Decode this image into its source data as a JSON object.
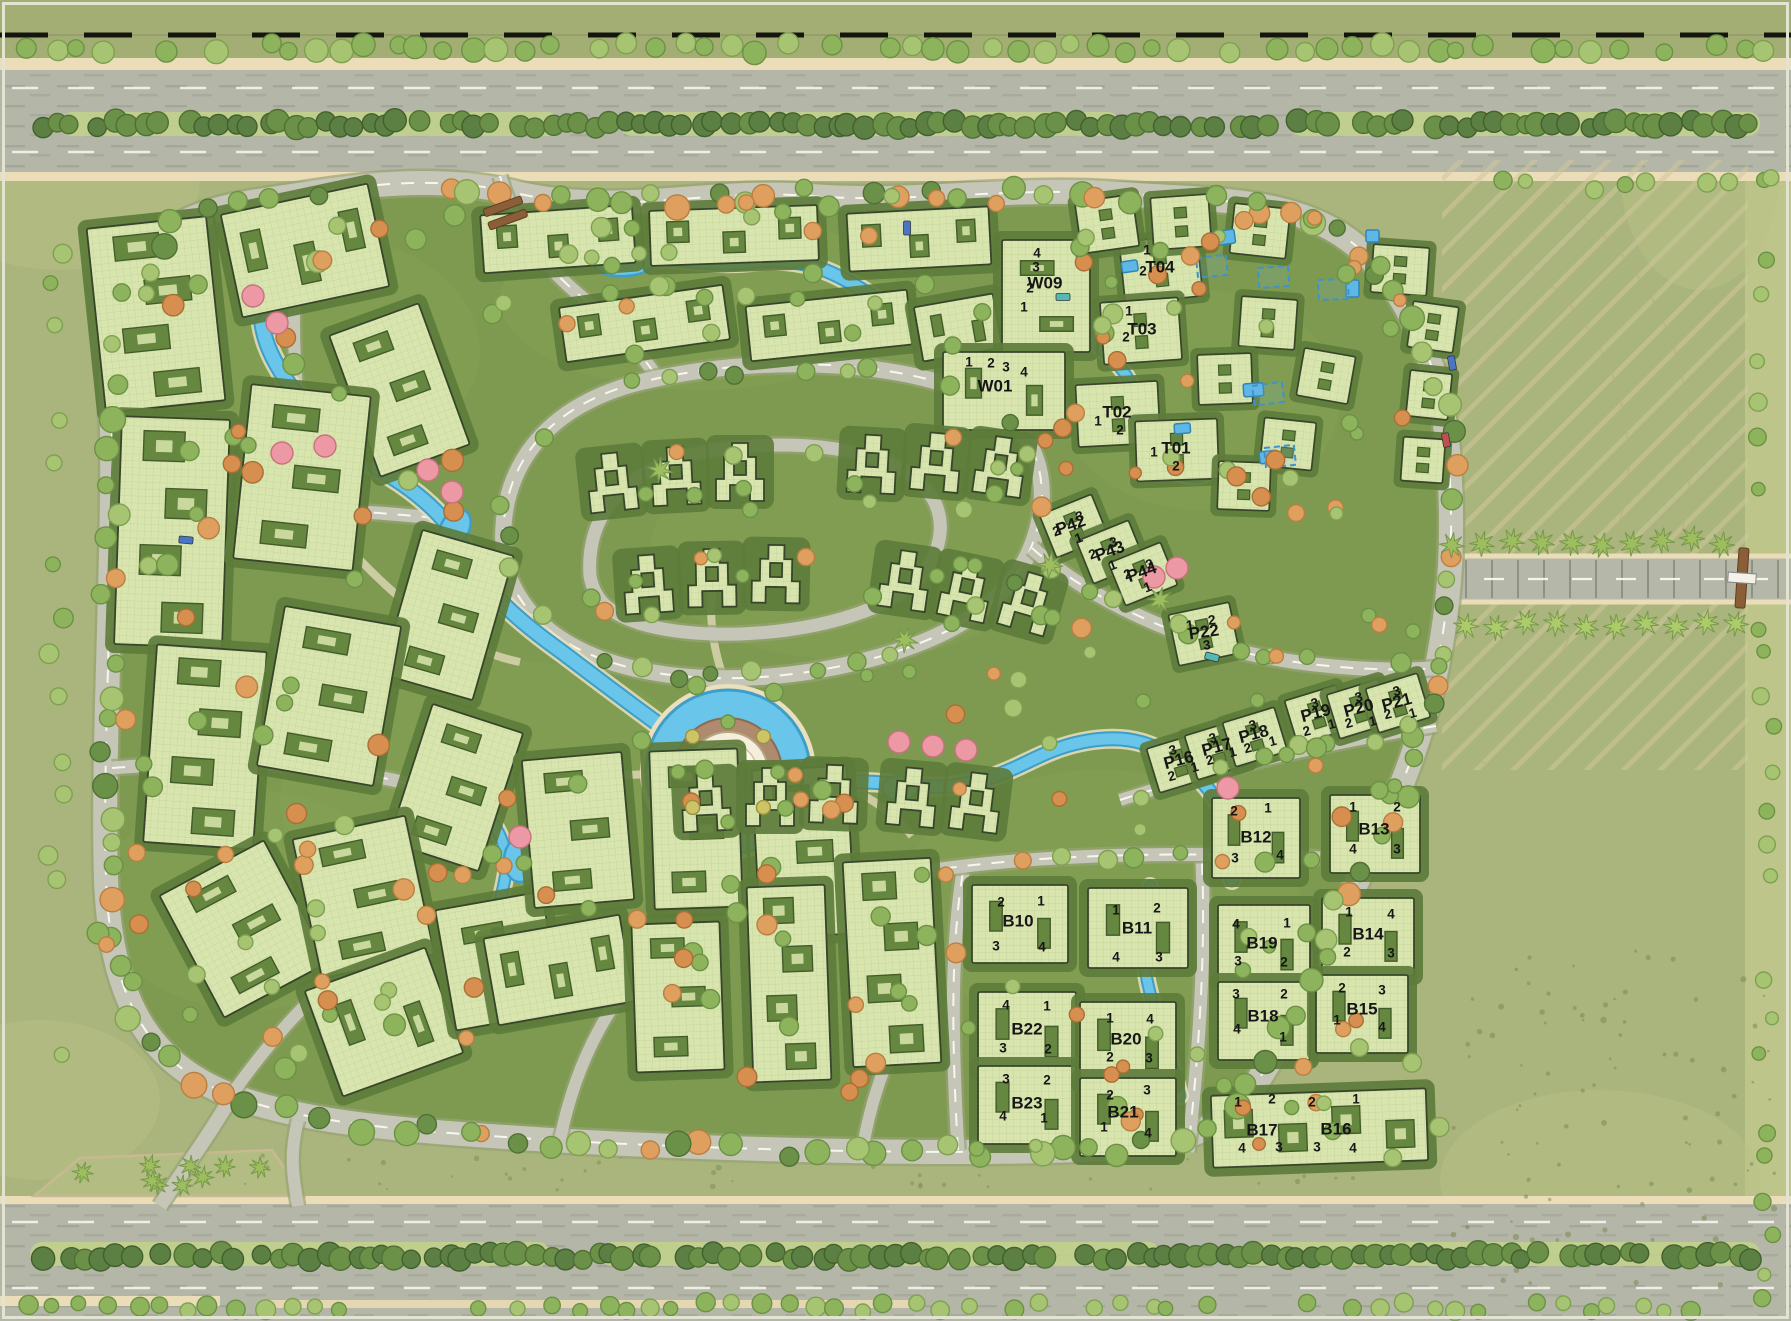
{
  "canvas": {
    "width": 1791,
    "height": 1321
  },
  "palette": {
    "land": "#aab47d",
    "land_light": "#c0c78c",
    "grass": "#7e9a50",
    "garden": "#5d7c3b",
    "building": "#d8e5ae",
    "outline": "#37462a",
    "courtyard": "#66873f",
    "courtyard_inner": "#d4e2a9",
    "road": "#c5c6b7",
    "highway": "#b4b6a8",
    "sidewalk": "#eaddb8",
    "road_line": "#fcfcf5",
    "water": "#69c6ea",
    "water_edge": "#3d9ec9",
    "water_bank": "#e9e0bd",
    "label": "#161616",
    "hatch": "#cfc79b",
    "plaza": "#b08a6e",
    "dome": "#f4eedb",
    "pool": "#5fb7e8",
    "gate": "#8a5f38",
    "tree_green": "#8db45c",
    "tree_light": "#a6c472",
    "tree_dark": "#5c7f43",
    "tree_orange": "#dfa05f",
    "tree_pink": "#ec99a5",
    "palm": "#9dbd5e"
  },
  "buildings": [
    {
      "id": "W09",
      "x": 1045,
      "y": 284,
      "rot": 0,
      "units": [
        [
          "4",
          1037,
          254
        ],
        [
          "3",
          1036,
          268
        ],
        [
          "2",
          1030,
          289
        ],
        [
          "1",
          1024,
          308
        ]
      ]
    },
    {
      "id": "W01",
      "x": 995,
      "y": 387,
      "rot": 0,
      "units": [
        [
          "1",
          969,
          363
        ],
        [
          "2",
          991,
          364
        ],
        [
          "3",
          1006,
          368
        ],
        [
          "4",
          1024,
          373
        ]
      ]
    },
    {
      "id": "T04",
      "x": 1160,
      "y": 268,
      "rot": 0,
      "units": [
        [
          "1",
          1147,
          251
        ],
        [
          "2",
          1143,
          272
        ]
      ]
    },
    {
      "id": "T03",
      "x": 1142,
      "y": 330,
      "rot": 0,
      "units": [
        [
          "1",
          1129,
          312
        ],
        [
          "2",
          1126,
          338
        ]
      ]
    },
    {
      "id": "T02",
      "x": 1117,
      "y": 413,
      "rot": 0,
      "units": [
        [
          "1",
          1098,
          422
        ],
        [
          "2",
          1120,
          431
        ]
      ]
    },
    {
      "id": "T01",
      "x": 1176,
      "y": 449,
      "rot": 0,
      "units": [
        [
          "1",
          1154,
          453
        ],
        [
          "2",
          1176,
          467
        ]
      ]
    },
    {
      "id": "P42",
      "x": 1071,
      "y": 526,
      "rot": -20,
      "units": [
        [
          "3",
          1080,
          517
        ],
        [
          "2",
          1057,
          532
        ],
        [
          "1",
          1079,
          539
        ]
      ]
    },
    {
      "id": "P43",
      "x": 1110,
      "y": 552,
      "rot": -20,
      "units": [
        [
          "3",
          1114,
          543
        ],
        [
          "2",
          1093,
          555
        ],
        [
          "1",
          1113,
          566
        ]
      ]
    },
    {
      "id": "P44",
      "x": 1142,
      "y": 573,
      "rot": -20,
      "units": [
        [
          "3",
          1150,
          565
        ],
        [
          "2",
          1128,
          575
        ],
        [
          "1",
          1148,
          588
        ]
      ]
    },
    {
      "id": "P22",
      "x": 1204,
      "y": 633,
      "rot": -8,
      "units": [
        [
          "1",
          1190,
          626
        ],
        [
          "2",
          1212,
          621
        ],
        [
          "3",
          1207,
          646
        ]
      ]
    },
    {
      "id": "P16",
      "x": 1179,
      "y": 761,
      "rot": -15,
      "units": [
        [
          "3",
          1173,
          751
        ],
        [
          "2",
          1172,
          777
        ],
        [
          "1",
          1195,
          768
        ]
      ]
    },
    {
      "id": "P17",
      "x": 1217,
      "y": 748,
      "rot": -15,
      "units": [
        [
          "3",
          1213,
          739
        ],
        [
          "2",
          1210,
          761
        ],
        [
          "1",
          1233,
          753
        ]
      ]
    },
    {
      "id": "P18",
      "x": 1254,
      "y": 735,
      "rot": -15,
      "units": [
        [
          "3",
          1253,
          726
        ],
        [
          "2",
          1248,
          749
        ],
        [
          "1",
          1273,
          742
        ]
      ]
    },
    {
      "id": "P19",
      "x": 1316,
      "y": 714,
      "rot": -15,
      "units": [
        [
          "3",
          1315,
          704
        ],
        [
          "2",
          1307,
          732
        ],
        [
          "1",
          1332,
          725
        ]
      ]
    },
    {
      "id": "P20",
      "x": 1359,
      "y": 709,
      "rot": -15,
      "units": [
        [
          "3",
          1359,
          698
        ],
        [
          "2",
          1349,
          724
        ],
        [
          "1",
          1373,
          722
        ]
      ]
    },
    {
      "id": "P21",
      "x": 1397,
      "y": 703,
      "rot": -15,
      "units": [
        [
          "3",
          1397,
          692
        ],
        [
          "2",
          1388,
          715
        ],
        [
          "1",
          1413,
          714
        ]
      ]
    },
    {
      "id": "B10",
      "x": 1018,
      "y": 922,
      "rot": 0,
      "units": [
        [
          "2",
          1001,
          903
        ],
        [
          "1",
          1041,
          902
        ],
        [
          "3",
          996,
          947
        ],
        [
          "4",
          1042,
          948
        ]
      ]
    },
    {
      "id": "B11",
      "x": 1137,
      "y": 929,
      "rot": 0,
      "units": [
        [
          "1",
          1116,
          911
        ],
        [
          "2",
          1157,
          909
        ],
        [
          "4",
          1116,
          958
        ],
        [
          "3",
          1159,
          958
        ]
      ]
    },
    {
      "id": "B12",
      "x": 1256,
      "y": 838,
      "rot": 0,
      "units": [
        [
          "2",
          1234,
          812
        ],
        [
          "1",
          1268,
          809
        ],
        [
          "3",
          1235,
          859
        ],
        [
          "4",
          1280,
          856
        ]
      ]
    },
    {
      "id": "B13",
      "x": 1374,
      "y": 830,
      "rot": 0,
      "units": [
        [
          "1",
          1353,
          808
        ],
        [
          "2",
          1397,
          808
        ],
        [
          "4",
          1353,
          850
        ],
        [
          "3",
          1397,
          850
        ]
      ]
    },
    {
      "id": "B22",
      "x": 1027,
      "y": 1030,
      "rot": 0,
      "units": [
        [
          "4",
          1006,
          1006
        ],
        [
          "1",
          1047,
          1007
        ],
        [
          "3",
          1003,
          1049
        ],
        [
          "2",
          1048,
          1050
        ]
      ]
    },
    {
      "id": "B23",
      "x": 1027,
      "y": 1104,
      "rot": 0,
      "units": [
        [
          "3",
          1006,
          1080
        ],
        [
          "2",
          1047,
          1081
        ],
        [
          "4",
          1003,
          1117
        ],
        [
          "1",
          1044,
          1119
        ]
      ]
    },
    {
      "id": "B20",
      "x": 1126,
      "y": 1040,
      "rot": 0,
      "units": [
        [
          "1",
          1110,
          1019
        ],
        [
          "4",
          1150,
          1020
        ],
        [
          "2",
          1110,
          1058
        ],
        [
          "3",
          1149,
          1059
        ]
      ]
    },
    {
      "id": "B21",
      "x": 1123,
      "y": 1113,
      "rot": 0,
      "units": [
        [
          "2",
          1110,
          1096
        ],
        [
          "3",
          1147,
          1091
        ],
        [
          "1",
          1104,
          1128
        ],
        [
          "4",
          1148,
          1134
        ]
      ]
    },
    {
      "id": "B19",
      "x": 1262,
      "y": 944,
      "rot": 0,
      "units": [
        [
          "4",
          1236,
          925
        ],
        [
          "1",
          1287,
          924
        ],
        [
          "3",
          1238,
          962
        ],
        [
          "2",
          1284,
          963
        ]
      ]
    },
    {
      "id": "B18",
      "x": 1263,
      "y": 1017,
      "rot": 0,
      "units": [
        [
          "3",
          1236,
          995
        ],
        [
          "2",
          1284,
          995
        ],
        [
          "4",
          1237,
          1030
        ],
        [
          "1",
          1283,
          1038
        ]
      ]
    },
    {
      "id": "B14",
      "x": 1368,
      "y": 935,
      "rot": 0,
      "units": [
        [
          "1",
          1349,
          913
        ],
        [
          "4",
          1391,
          915
        ],
        [
          "2",
          1347,
          953
        ],
        [
          "3",
          1391,
          954
        ]
      ]
    },
    {
      "id": "B15",
      "x": 1362,
      "y": 1010,
      "rot": 0,
      "units": [
        [
          "2",
          1342,
          989
        ],
        [
          "3",
          1382,
          991
        ],
        [
          "1",
          1337,
          1021
        ],
        [
          "4",
          1382,
          1028
        ]
      ]
    },
    {
      "id": "B17",
      "x": 1262,
      "y": 1131,
      "rot": 0,
      "units": [
        [
          "1",
          1238,
          1103
        ],
        [
          "2",
          1272,
          1100
        ],
        [
          "4",
          1242,
          1149
        ],
        [
          "3",
          1279,
          1148
        ]
      ]
    },
    {
      "id": "B16",
      "x": 1336,
      "y": 1130,
      "rot": 0,
      "units": [
        [
          "2",
          1312,
          1103
        ],
        [
          "1",
          1356,
          1100
        ],
        [
          "3",
          1317,
          1148
        ],
        [
          "4",
          1353,
          1149
        ]
      ]
    }
  ]
}
